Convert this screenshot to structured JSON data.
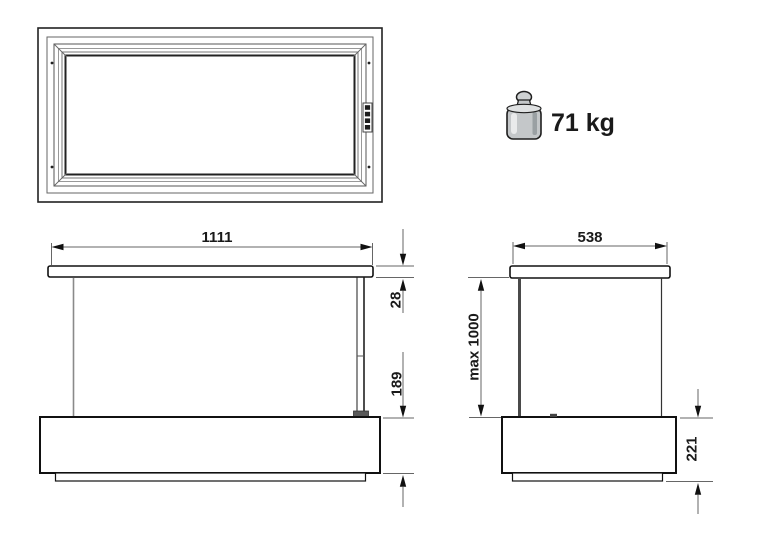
{
  "diagram": {
    "type": "appliance-dimension-drawing",
    "views": {
      "top_view": {
        "description": "plan view of ceiling frame with corner screws and control strip"
      },
      "front_view": {
        "width": "1111",
        "top_plate_thickness": "28",
        "body_height": "189"
      },
      "side_view": {
        "depth": "538",
        "max_extension": "max 1000",
        "base_height": "221"
      }
    },
    "weight": {
      "label": "71 kg"
    },
    "colors": {
      "edge": "#111111",
      "dim_line": "#666666",
      "arrow": "#111111",
      "metal_light": "#dfe1e2",
      "metal_mid": "#c4c7c9",
      "metal_dark": "#9aa0a3",
      "background": "#ffffff"
    }
  }
}
